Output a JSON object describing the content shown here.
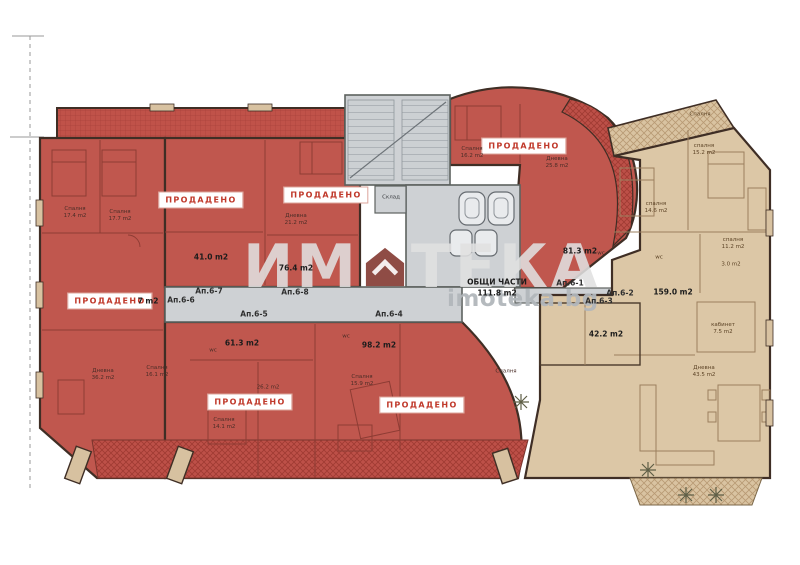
{
  "labels": {
    "sold": "ПРОДАДЕНО"
  },
  "watermark": {
    "left": "ИМ",
    "right": "ТЕКА",
    "site": "imoteka.bg",
    "house_icon": "house-icon"
  },
  "common": {
    "title": "ОБЩИ ЧАСТИ",
    "area": "111.8 m2"
  },
  "units": {
    "a61": {
      "id": "Ап.6-1",
      "area": "81.3 m2"
    },
    "a62": {
      "id": "Ап.6-2",
      "area": "159.0 m2"
    },
    "a63": {
      "id": "Ап.6-3",
      "area": "42.2 m2"
    },
    "a64": {
      "id": "Ап.6-4",
      "area": "98.2 m2"
    },
    "a65": {
      "id": "Ап.6-5",
      "area": "61.3 m2"
    },
    "a66": {
      "id": "Ап.6-6",
      "area": "7 m2"
    },
    "a67": {
      "id": "Ап.6-7",
      "area": "41.0 m2"
    },
    "a68": {
      "id": "Ап.6-8",
      "area": "76.4 m2"
    }
  },
  "rooms": {
    "bedroom_17_4": {
      "name": "Спалня",
      "area": "17.4 m2"
    },
    "bedroom_17_7": {
      "name": "Спалня",
      "area": "17.7 m2"
    },
    "living_21_2": {
      "name": "Дневна",
      "area": "21.2 m2"
    },
    "living_36_2": {
      "name": "Дневна",
      "area": "36.2 m2"
    },
    "bedroom_16_1": {
      "name": "Спалня",
      "area": "16.1 m2"
    },
    "bedroom_14_1": {
      "name": "Спалня",
      "area": "14.1 m2"
    },
    "living_26_2": {
      "name": "",
      "area": "26.2 m2"
    },
    "bedroom_15_9": {
      "name": "Спалня",
      "area": "15.9 m2"
    },
    "bedroom_mid": {
      "name": "Спалня",
      "area": ""
    },
    "bedroom_16_2": {
      "name": "Спалня",
      "area": "16.2 m2"
    },
    "living_25_8": {
      "name": "Дневна",
      "area": "25.8 m2"
    },
    "storage": {
      "name": "Склад",
      "area": ""
    },
    "bedroom_15_2": {
      "name": "спалня",
      "area": "15.2 m2"
    },
    "bedroom_14_6": {
      "name": "спалня",
      "area": "14.6 m2"
    },
    "bedroom_11_2": {
      "name": "спалня",
      "area": "11.2 m2"
    },
    "wc_3_0": {
      "name": "",
      "area": "3.0 m2"
    },
    "office_7_5": {
      "name": "кабинет",
      "area": "7.5 m2"
    },
    "living_43_5": {
      "name": "Дневна",
      "area": "43.5 m2"
    },
    "terrace_bedroom": {
      "name": "Спалня",
      "area": ""
    },
    "wc": {
      "name": "wc",
      "area": ""
    }
  },
  "colors": {
    "sold_fill": "#c0574e",
    "available_fill": "#dcc7a6",
    "common_fill": "#ced1d4",
    "wall": "#3f2e25",
    "badge_text": "#c0392b",
    "watermark_house": "#7b2d24"
  }
}
